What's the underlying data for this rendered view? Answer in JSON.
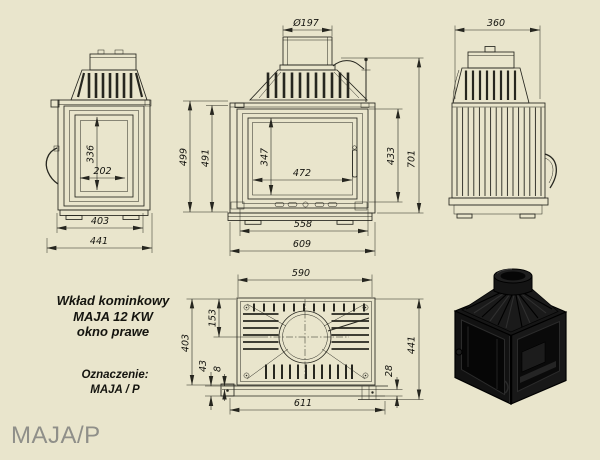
{
  "colors": {
    "background": "#e9e5cc",
    "drawing_line": "#26261f",
    "caption_text": "#8f8f89",
    "render_black": "#121212"
  },
  "caption": "MAJA/P",
  "title_block": {
    "line1": "Wkład kominkowy",
    "line2": "MAJA 12 KW",
    "line3": "okno prawe",
    "designation_label": "Oznaczenie:",
    "designation_value": "MAJA / P"
  },
  "dimensions": {
    "flue_diameter": "Ø197",
    "rear_width": "360",
    "side_glass_height": "336",
    "side_glass_width": "202",
    "side_depth": "403",
    "side_depth_total": "441",
    "front_height": "499",
    "front_height_inner": "491",
    "glass_height": "347",
    "glass_width": "472",
    "door_height": "433",
    "total_height": "701",
    "front_width": "558",
    "front_width_total": "609",
    "top_width": "590",
    "top_flue_center": "153",
    "top_depth": "403",
    "top_foot": "43",
    "top_gap": "8",
    "top_rear_gap": "28",
    "top_depth_total": "441",
    "top_width_total": "611"
  }
}
